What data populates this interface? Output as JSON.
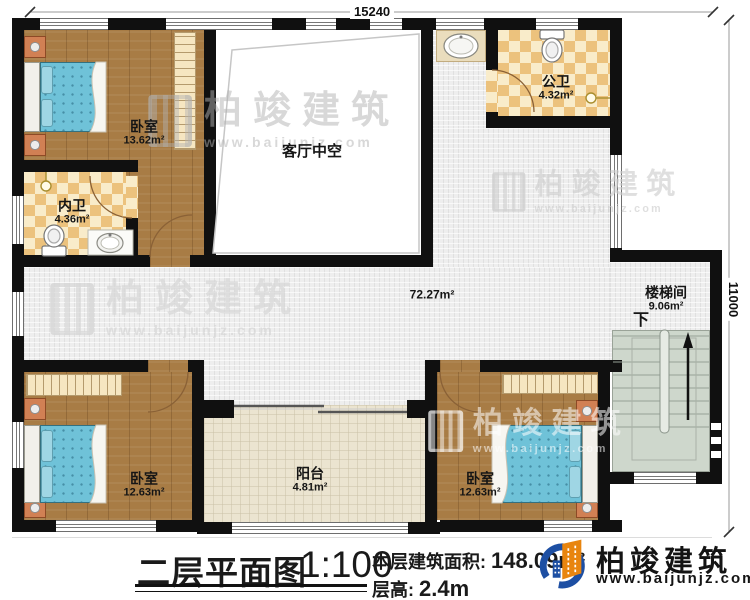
{
  "dimensions": {
    "top_width": "15240",
    "right_height": "11000"
  },
  "rooms": [
    {
      "name": "卧室",
      "area": "13.62m²"
    },
    {
      "name": "内卫",
      "area": "4.36m²"
    },
    {
      "name": "客厅中空",
      "area": ""
    },
    {
      "name": "公卫",
      "area": "4.32m²"
    },
    {
      "name": "楼梯间",
      "area": "9.06m²"
    },
    {
      "name": "卧室",
      "area": "12.63m²"
    },
    {
      "name": "阳台",
      "area": "4.81m²"
    },
    {
      "name": "卧室",
      "area": "12.63m²"
    }
  ],
  "hall_area": "72.27m²",
  "stair_down_label": "下",
  "footer": {
    "title": "二层平面图",
    "scale": "1:100",
    "area_label": "本层建筑面积:",
    "area_value": "148.09m²",
    "floor_height_label": "层高:",
    "floor_height_value": "2.4m"
  },
  "brand": {
    "name": "柏竣建筑",
    "url": "www.baijunjz.com"
  },
  "watermark": {
    "text": "柏竣建筑",
    "url": "www.baijunjz.com"
  },
  "colors": {
    "wall": "#101010",
    "wood_floor": "#a87c45",
    "hall_tile": "#eeeeee",
    "bath_checker": "#ecc27d",
    "balcony_tile": "#ebe4d0",
    "stairs": "#ced7cc",
    "bed": "#6fc2d8",
    "brand_blue": "#1d4fa3",
    "brand_orange": "#e8850f"
  }
}
